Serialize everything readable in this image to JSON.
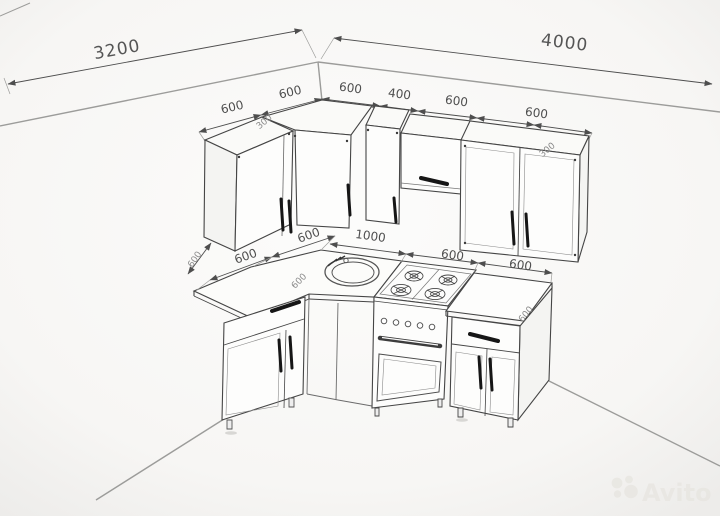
{
  "watermark": {
    "brand": "Avito"
  },
  "dims": {
    "wall_left": "3200",
    "wall_right": "4000",
    "upper": [
      "600",
      "600",
      "600",
      "400",
      "600",
      "600"
    ],
    "upper_depth_notes": [
      "300",
      "300"
    ],
    "base_left": [
      "600",
      "600"
    ],
    "base_right": [
      "1000",
      "600",
      "600"
    ],
    "left_depth_note": "600",
    "counter_note_left": "600",
    "counter_note_right": "600"
  }
}
